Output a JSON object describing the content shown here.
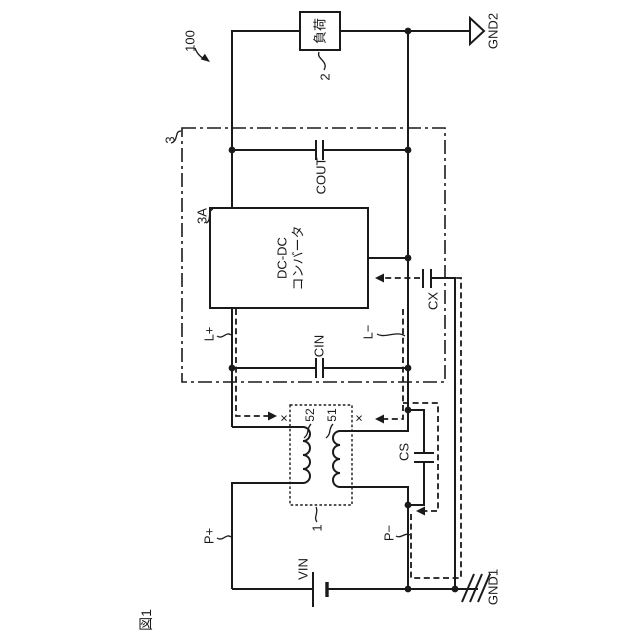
{
  "figure_label": "図1",
  "labels": {
    "ref_100": "100",
    "load": "負荷",
    "ref_2": "2",
    "gnd2": "GND2",
    "ref_3": "3",
    "cout": "COUT",
    "ref_3a": "3A",
    "converter_line1": "DC-DC",
    "converter_line2": "コンバータ",
    "l_plus": "L+",
    "l_minus": "L−",
    "cin": "CIN",
    "cx": "CX",
    "cs": "CS",
    "ref_52": "52",
    "ref_51": "51",
    "cross_mark_left": "×",
    "cross_mark_right": "×",
    "ref_1": "1",
    "p_plus": "P+",
    "p_minus": "P−",
    "vin": "VIN",
    "gnd1": "GND1"
  },
  "colors": {
    "ink": "#1a1a1a",
    "background": "#ffffff"
  }
}
